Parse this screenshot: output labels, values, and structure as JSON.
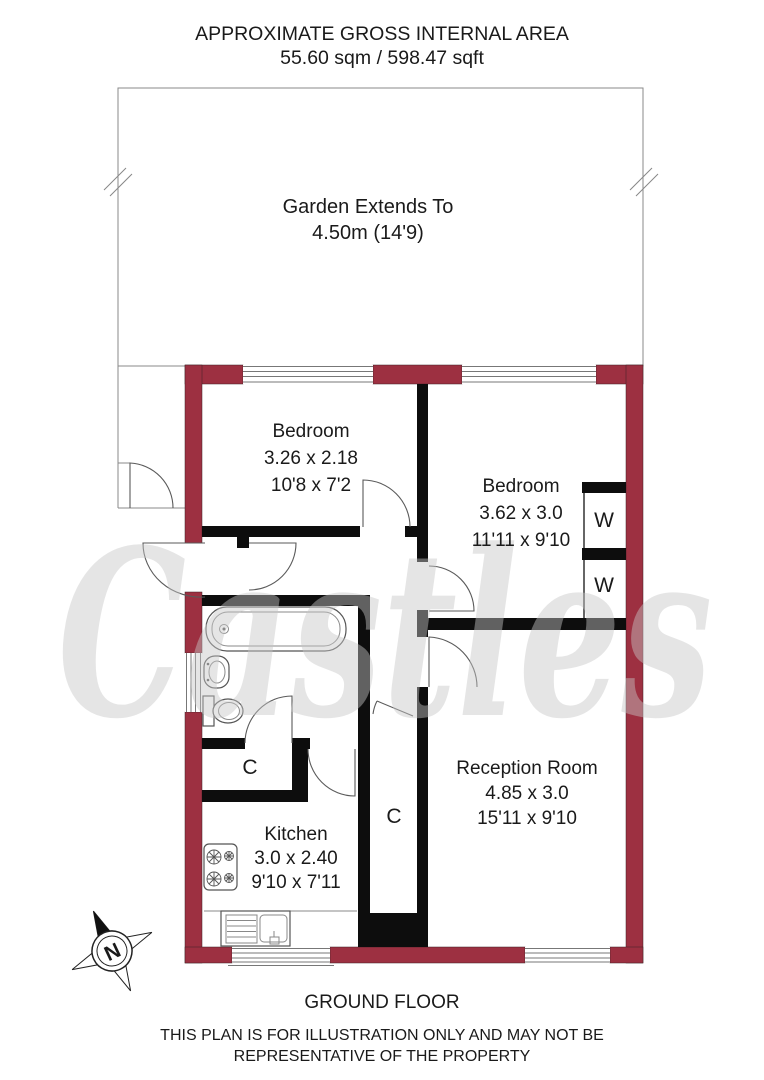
{
  "header": {
    "title": "APPROXIMATE GROSS INTERNAL AREA",
    "area": "55.60 sqm / 598.47 sqft"
  },
  "garden": {
    "line1": "Garden Extends To",
    "line2": "4.50m (14'9)"
  },
  "rooms": [
    {
      "name": "Bedroom",
      "metric": "3.26 x 2.18",
      "imperial": "10'8 x 7'2"
    },
    {
      "name": "Bedroom",
      "metric": "3.62 x 3.0",
      "imperial": "11'11 x 9'10"
    },
    {
      "name": "Reception Room",
      "metric": "4.85 x 3.0",
      "imperial": "15'11 x 9'10"
    },
    {
      "name": "Kitchen",
      "metric": "3.0 x 2.40",
      "imperial": "9'10 x 7'11"
    }
  ],
  "labels": {
    "wardrobe": "W",
    "cupboard": "C"
  },
  "compass": {
    "north": "N"
  },
  "watermark": "Castles",
  "footer": {
    "floor": "GROUND FLOOR",
    "disclaimer1": "THIS PLAN IS FOR ILLUSTRATION ONLY AND MAY NOT BE",
    "disclaimer2": "REPRESENTATIVE OF THE PROPERTY"
  },
  "colors": {
    "outer_wall": "#9d3041",
    "inner_wall": "#0d0d0d",
    "thin_line": "#5a5a5a",
    "watermark": "#c7c7c7",
    "text": "#1a1a1a"
  }
}
